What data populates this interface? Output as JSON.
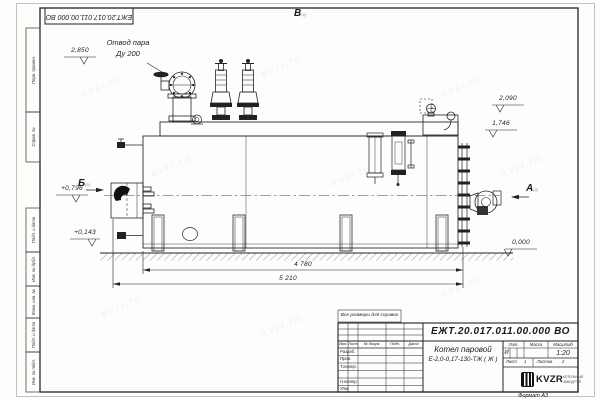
{
  "sheet": {
    "stamp_top_left": "ЕЖТ.20.017.011.00.000 ВО",
    "note_reference": "Все размеры для справок",
    "format_label": "Формат  А3",
    "watermark": "kvzr.ru"
  },
  "margin_columns": [
    "Перв. примен.",
    "Справ. №",
    "Подп. и дата",
    "Инв. № дубл.",
    "Взам. инв. №",
    "Подп. и дата",
    "Инв. № подл."
  ],
  "views": {
    "top": {
      "letter": "В",
      "ref": "(2)"
    },
    "left": {
      "letter": "Б",
      "ref": "(2)"
    },
    "right": {
      "letter": "А",
      "ref": "(2)"
    }
  },
  "callouts": {
    "steam_outlet_line1": "Отвод пара",
    "steam_outlet_line2": "Ду 200"
  },
  "elevations": {
    "steam_outlet": "2,850",
    "drum_top": "2,090",
    "shell_top": "1,746",
    "burner_axis": "+0,796",
    "base": "+0,143",
    "ground": "0,000"
  },
  "dimensions": {
    "body_length": "4 780",
    "overall_length": "5 210"
  },
  "title_block": {
    "doc_number": "ЕЖТ.20.017.011.00.000  ВО",
    "product_name_line1": "Котел паровой",
    "product_name_line2": "Е-2,0-0,17-130-ТЖ ( Ж )",
    "col_lit": "Лит.",
    "col_mass": "Масса",
    "col_scale": "Масштаб",
    "lit_value": "И",
    "scale_value": "1:20",
    "sheet_label": "Лист",
    "sheet_value": "1",
    "sheets_label": "Листов",
    "sheets_value": "2",
    "header_cells": [
      "Изм.",
      "Лист",
      "№ докум.",
      "Подп.",
      "Дата"
    ],
    "signature_rows": [
      "Разраб.",
      "Пров.",
      "Т.контр.",
      "Н.контр.",
      "Утв."
    ],
    "logo_text": "KVZR",
    "logo_caption_line1": "КОТЕЛЬНЫЙ",
    "logo_caption_line2": "ЗАВОД РЭП"
  }
}
